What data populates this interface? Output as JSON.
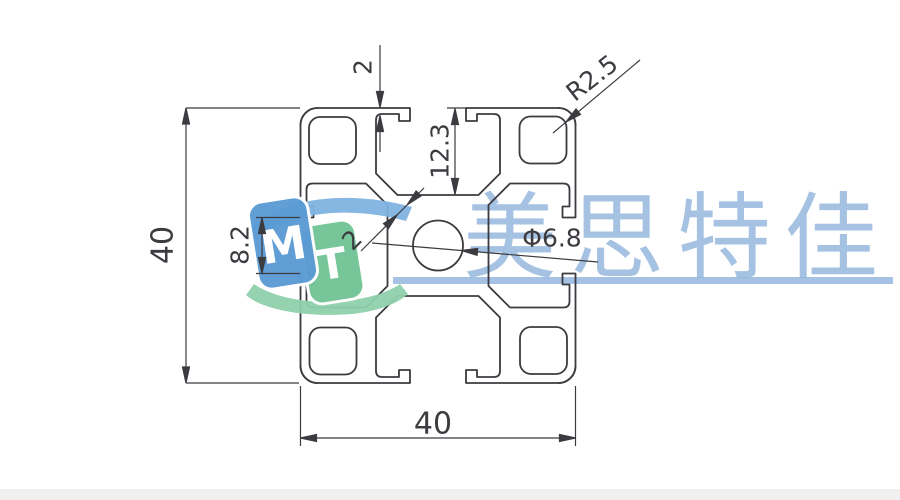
{
  "drawing": {
    "dimensions": {
      "overall_height": "40",
      "overall_width": "40",
      "slot_lip_thickness": "2",
      "slot_depth": "12.3",
      "slot_opening": "8.2",
      "corner_radius": "R2.5",
      "center_hole_diameter": "Φ6.8",
      "web_thickness": "2"
    },
    "colors": {
      "line": "#3b3b40",
      "watermark_blue": "#8FB3DD",
      "logo_blue": "#5B9BD5",
      "logo_blue_light": "#7FB3E0",
      "logo_green": "#72C495",
      "logo_green_light": "#8FD1AC",
      "footer_bar": "#f0f0f0"
    }
  },
  "watermark": {
    "text": "美思特佳",
    "logo_m": "M",
    "logo_t": "T"
  }
}
